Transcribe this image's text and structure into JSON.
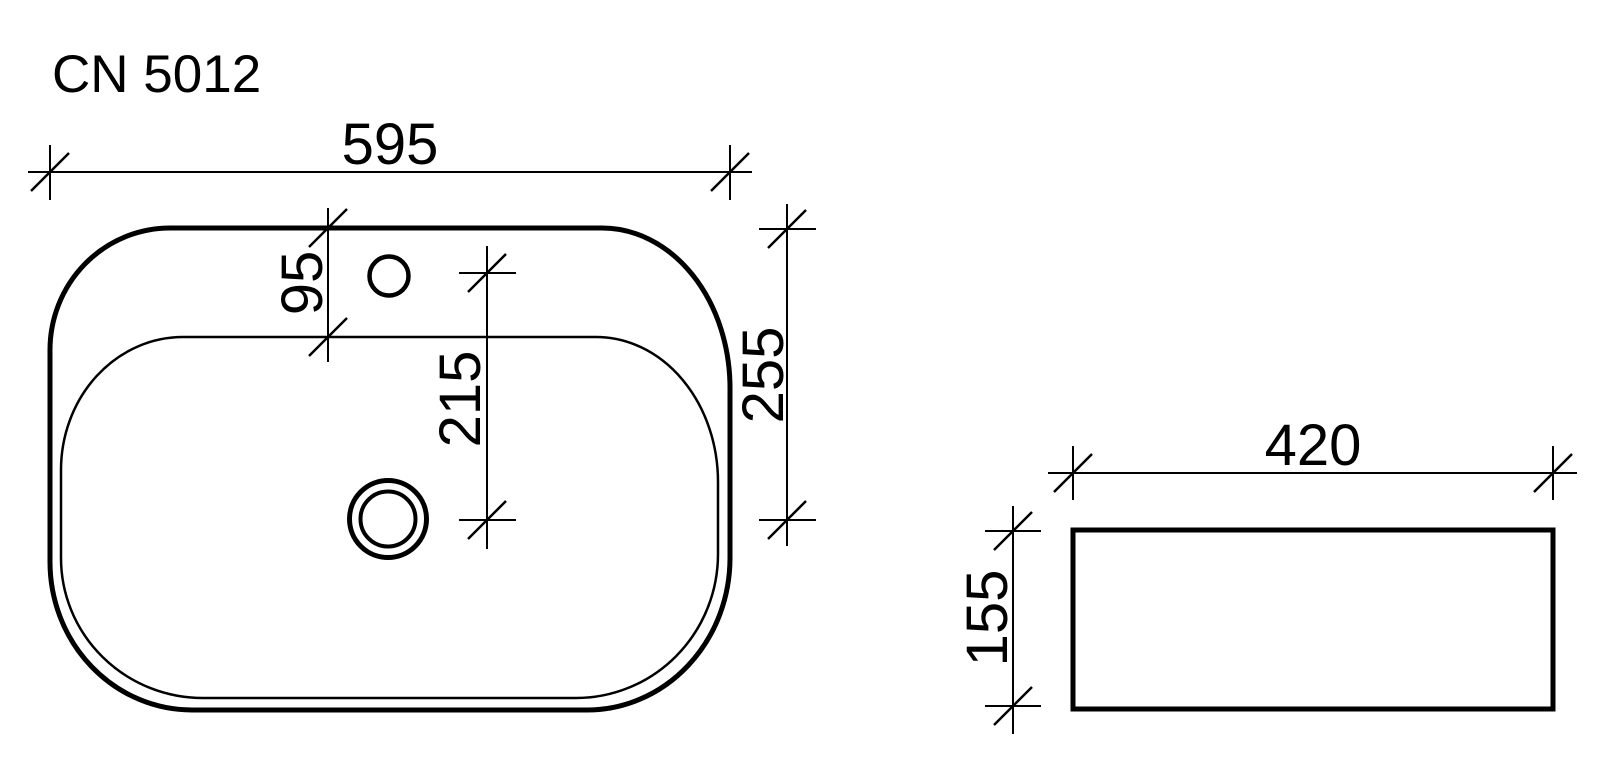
{
  "drawing": {
    "model": "CN 5012",
    "type": "washbasin-dimension-drawing",
    "views": [
      "top-view",
      "side-view"
    ]
  },
  "colors": {
    "line": "#000000",
    "background": "#ffffff"
  },
  "top_view": {
    "dims": {
      "overall_width": "595",
      "rim_to_basin": "95",
      "faucet_to_drain": "215",
      "rim_to_drain": "255"
    },
    "features": [
      "outer-rim",
      "inner-basin",
      "faucet-hole",
      "drain-hole"
    ]
  },
  "side_view": {
    "dims": {
      "depth": "420",
      "height": "155"
    }
  }
}
